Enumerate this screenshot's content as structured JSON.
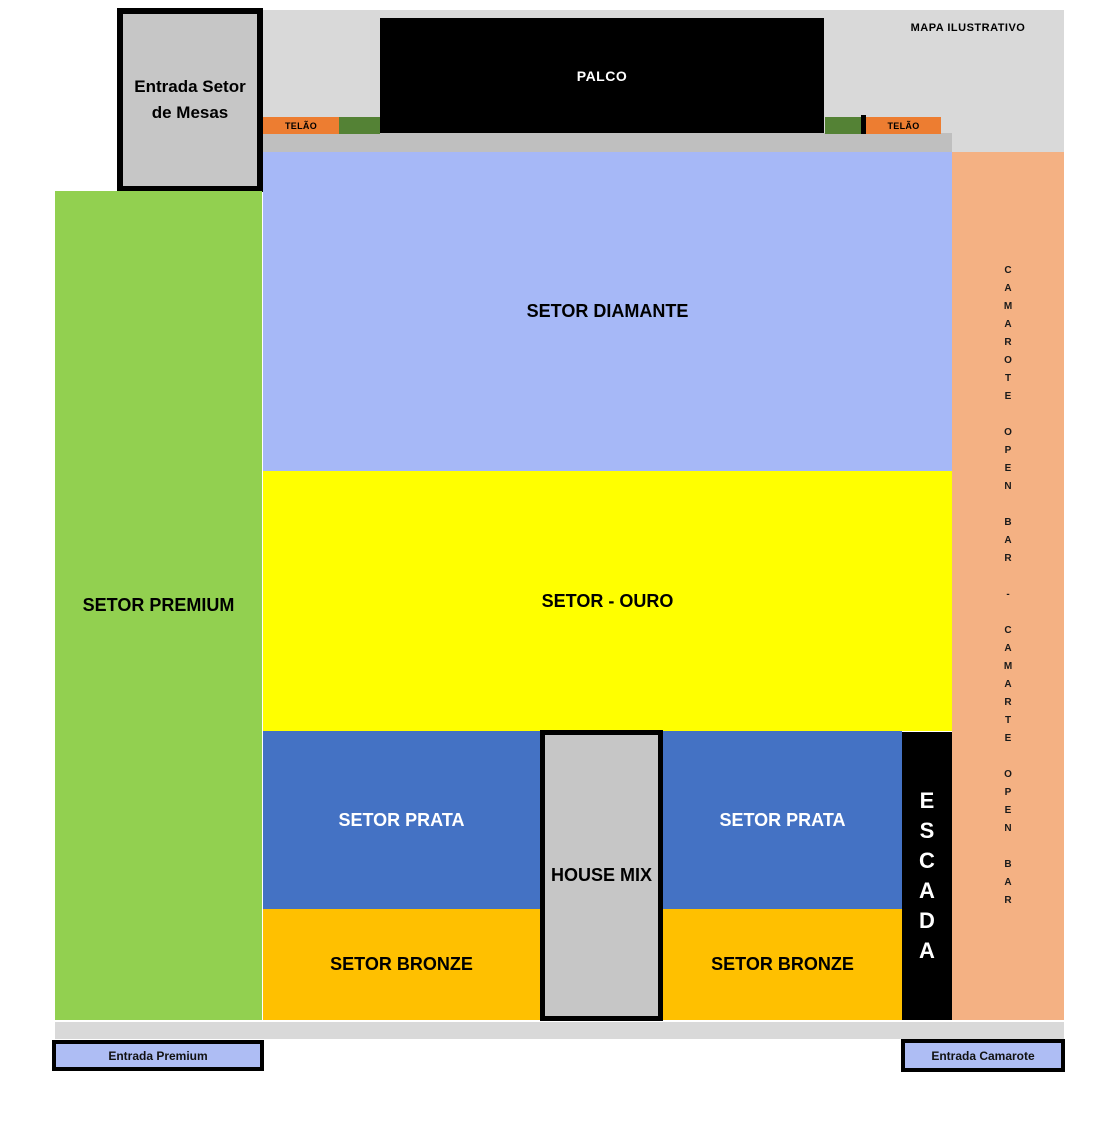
{
  "note": "MAPA ILUSTRATIVO",
  "stage": {
    "label": "PALCO"
  },
  "screens": {
    "left_label": "TELÃO",
    "right_label": "TELÃO"
  },
  "entrances": {
    "mesas_line1": "Entrada Setor",
    "mesas_line2": "de Mesas",
    "premium": "Entrada Premium",
    "camarote": "Entrada Camarote"
  },
  "sectors": {
    "premium": "SETOR PREMIUM",
    "diamante": "SETOR DIAMANTE",
    "ouro": "SETOR - OURO",
    "prata_left": "SETOR PRATA",
    "prata_right": "SETOR PRATA",
    "bronze_left": "SETOR BRONZE",
    "bronze_right": "SETOR BRONZE",
    "house_mix": "HOUSE MIX",
    "escada": "ESCADA",
    "camarote_words": [
      "CAMAROTE",
      "OPEN",
      "BAR",
      "-",
      "CAMARTE",
      "OPEN",
      "BAR"
    ]
  },
  "colors": {
    "top_band": "#D9D9D9",
    "mid_band": "#BFBFBF",
    "stage": "#000000",
    "telao": "#ED7D31",
    "green_strip": "#548235",
    "diamante": "#A6B8F7",
    "ouro": "#FFFF00",
    "prata": "#4472C4",
    "bronze": "#FFC000",
    "premium": "#92D050",
    "camarote": "#F4B183",
    "gray_box": "#C6C6C6",
    "entrance_fill": "#AEBDF4"
  }
}
